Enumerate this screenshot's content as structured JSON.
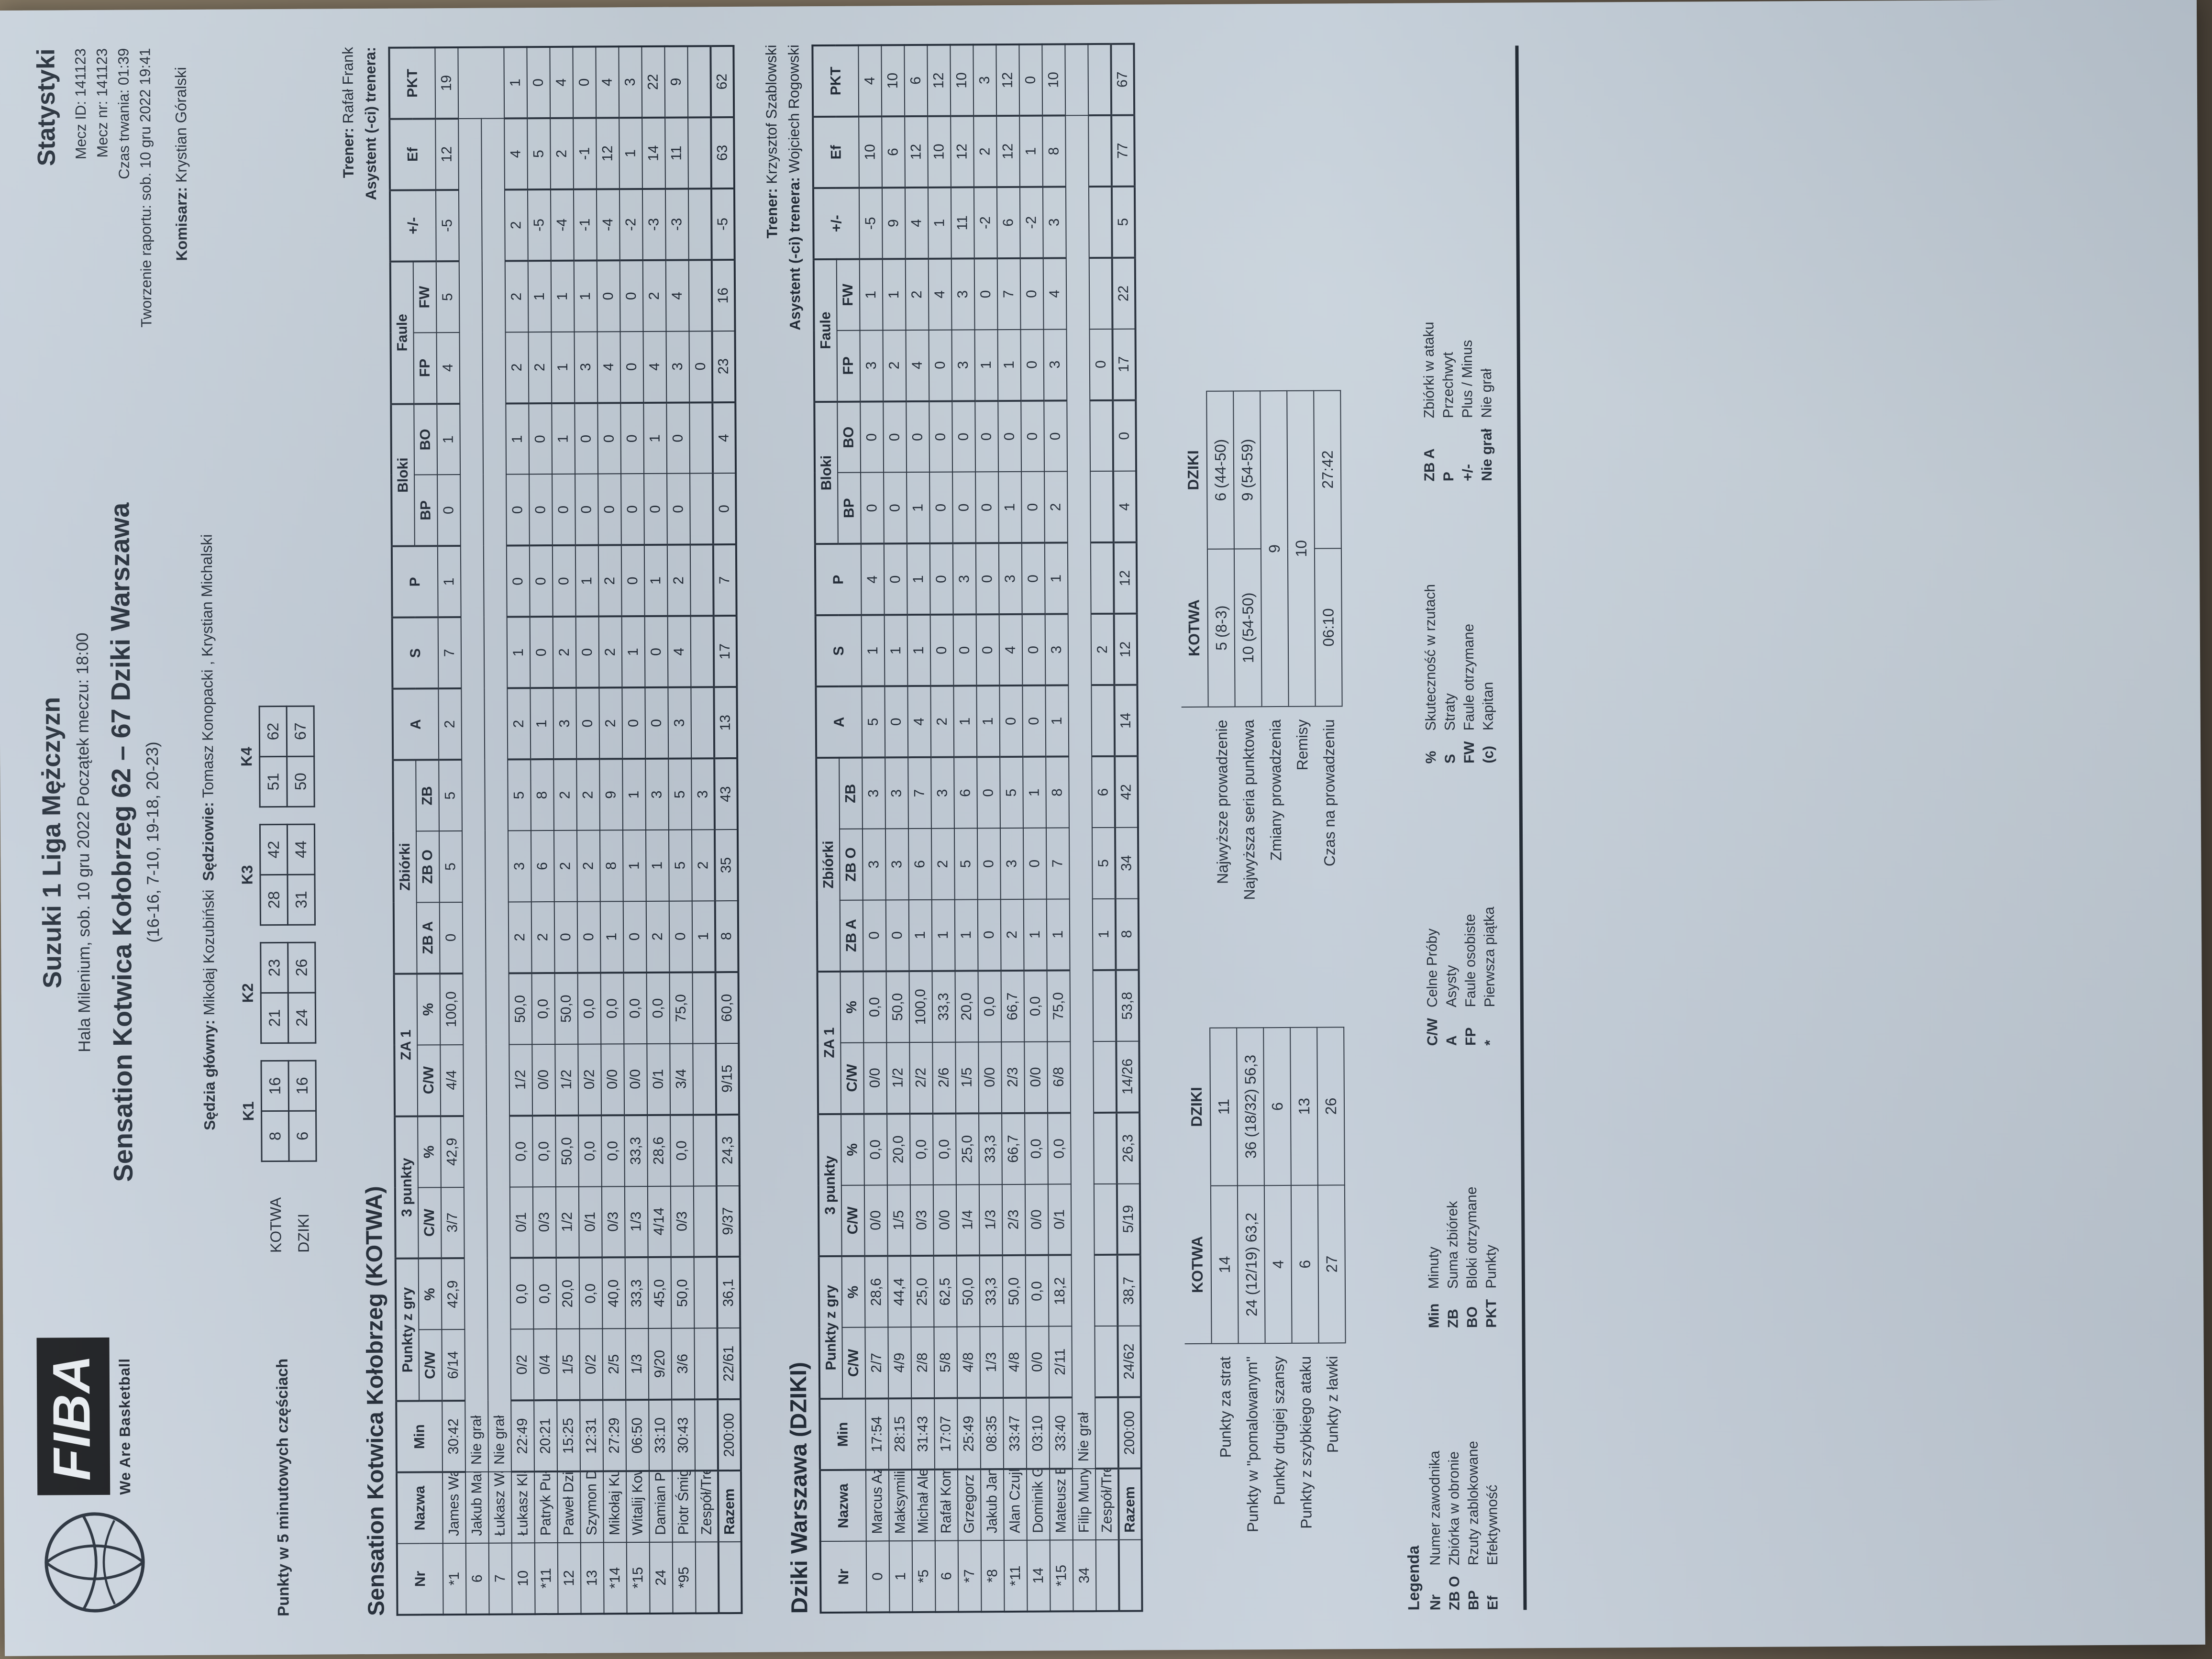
{
  "header": {
    "logo": {
      "fiba": "FIBA",
      "tagline": "We Are Basketball"
    },
    "title": "Suzuki 1 Liga Mężczyzn",
    "subtitle": "Hala Milenium, sob. 10 gru 2022 Początek meczu: 18:00",
    "match_line": "Sensation Kotwica Kołobrzeg 62 – 67 Dziki Warszawa",
    "quarters_line": "(16-16, 7-10, 19-18, 20-23)",
    "stats_label": "Statystyki",
    "meta": [
      "Mecz ID: 141123",
      "Mecz nr: 141123",
      "Czas trwania: 01:39",
      "Tworzenie raportu: sob. 10 gru 2022 19:41"
    ],
    "commissioner": {
      "label": "Komisarz:",
      "value": "Krystian Góralski"
    },
    "referee_main": {
      "label": "Sędzia główny:",
      "value": "Mikołaj Kozubiński"
    },
    "referees": {
      "label": "Sędziowie:",
      "value": "Tomasz Konopacki , Krystian Michalski"
    }
  },
  "quarter_scores": {
    "label": "Punkty w 5 minutowych częściach",
    "teams": [
      "KOTWA",
      "DZIKI"
    ],
    "quarters": [
      "K1",
      "K2",
      "K3",
      "K4"
    ],
    "values": [
      [
        [
          "8",
          "16"
        ],
        [
          "21",
          "23"
        ],
        [
          "28",
          "42"
        ],
        [
          "51",
          "62"
        ]
      ],
      [
        [
          "6",
          "16"
        ],
        [
          "24",
          "26"
        ],
        [
          "31",
          "44"
        ],
        [
          "50",
          "67"
        ]
      ]
    ]
  },
  "roster_header": {
    "top": [
      {
        "t": "Nr",
        "rs": 2
      },
      {
        "t": "Nazwa",
        "rs": 2
      },
      {
        "t": "Min",
        "rs": 2
      },
      {
        "t": "Punkty z gry",
        "cs": 2
      },
      {
        "t": "3 punkty",
        "cs": 2
      },
      {
        "t": "ZA 1",
        "cs": 2
      },
      {
        "t": "Zbiórki",
        "cs": 3
      },
      {
        "t": "A",
        "rs": 2
      },
      {
        "t": "S",
        "rs": 2
      },
      {
        "t": "P",
        "rs": 2
      },
      {
        "t": "Bloki",
        "cs": 2
      },
      {
        "t": "Faule",
        "cs": 2
      },
      {
        "t": "+/-",
        "rs": 2
      },
      {
        "t": "Ef",
        "rs": 2
      },
      {
        "t": "PKT",
        "rs": 2
      }
    ],
    "bottom": [
      "C/W",
      "%",
      "C/W",
      "%",
      "C/W",
      "%",
      "ZB A",
      "ZB O",
      "ZB",
      "BP",
      "BO",
      "FP",
      "FW"
    ]
  },
  "tables": [
    {
      "section_title": "Sensation Kotwica Kołobrzeg (KOTWA)",
      "coach": {
        "label": "Trener:",
        "value": "Rafał Frank"
      },
      "assistant": {
        "label": "Asystent (-ci) trenera:",
        "value": ""
      },
      "rows": [
        {
          "cells": [
            "*1",
            "James Washington",
            "30:42",
            "6/14",
            "42,9",
            "3/7",
            "42,9",
            "4/4",
            "100,0",
            "0",
            "5",
            "5",
            "2",
            "7",
            "1",
            "0",
            "1",
            "4",
            "5",
            "-5",
            "12",
            "19"
          ]
        },
        {
          "dnp": true,
          "cells": [
            "6",
            "Jakub Marchlewski",
            "Nie grał"
          ]
        },
        {
          "dnp": true,
          "cells": [
            "7",
            "Łukasz Walkowiak",
            "Nie grał"
          ]
        },
        {
          "cells": [
            "10",
            "Łukasz Klawa",
            "22:49",
            "0/2",
            "0,0",
            "0/1",
            "0,0",
            "1/2",
            "50,0",
            "2",
            "3",
            "5",
            "2",
            "1",
            "0",
            "0",
            "1",
            "2",
            "2",
            "2",
            "4",
            "1"
          ]
        },
        {
          "cells": [
            "*11",
            "Patryk Pułkotycki",
            "20:21",
            "0/4",
            "0,0",
            "0/3",
            "0,0",
            "0/0",
            "0,0",
            "2",
            "6",
            "8",
            "1",
            "0",
            "0",
            "0",
            "0",
            "2",
            "1",
            "-5",
            "5",
            "0"
          ]
        },
        {
          "cells": [
            "12",
            "Paweł Dzierżak",
            "15:25",
            "1/5",
            "20,0",
            "1/2",
            "50,0",
            "1/2",
            "50,0",
            "0",
            "2",
            "2",
            "3",
            "2",
            "0",
            "0",
            "1",
            "1",
            "1",
            "-4",
            "2",
            "4"
          ]
        },
        {
          "cells": [
            "13",
            "Szymon Długosz",
            "12:31",
            "0/2",
            "0,0",
            "0/1",
            "0,0",
            "0/2",
            "0,0",
            "0",
            "2",
            "2",
            "0",
            "0",
            "1",
            "0",
            "0",
            "3",
            "1",
            "-1",
            "-1",
            "0"
          ]
        },
        {
          "cells": [
            "*14",
            "Mikołaj Kurpisz",
            "27:29",
            "2/5",
            "40,0",
            "0/3",
            "0,0",
            "0/0",
            "0,0",
            "1",
            "8",
            "9",
            "2",
            "2",
            "2",
            "0",
            "0",
            "4",
            "0",
            "-4",
            "12",
            "4"
          ]
        },
        {
          "cells": [
            "*15",
            "Witalij Kowalenko",
            "06:50",
            "1/3",
            "33,3",
            "1/3",
            "33,3",
            "0/0",
            "0,0",
            "0",
            "1",
            "1",
            "0",
            "1",
            "0",
            "0",
            "0",
            "0",
            "0",
            "-2",
            "1",
            "3"
          ]
        },
        {
          "cells": [
            "24",
            "Damian Pieloch",
            "33:10",
            "9/20",
            "45,0",
            "4/14",
            "28,6",
            "0/1",
            "0,0",
            "2",
            "1",
            "3",
            "0",
            "0",
            "1",
            "0",
            "1",
            "4",
            "2",
            "-3",
            "14",
            "22"
          ]
        },
        {
          "cells": [
            "*95",
            "Piotr Śmigielski (C)",
            "30:43",
            "3/6",
            "50,0",
            "0/3",
            "0,0",
            "3/4",
            "75,0",
            "0",
            "5",
            "5",
            "3",
            "4",
            "2",
            "0",
            "0",
            "3",
            "4",
            "-3",
            "11",
            "9"
          ]
        }
      ],
      "team_row": [
        "",
        "Zespół/Trener",
        "",
        "",
        "",
        "",
        "",
        "",
        "",
        "1",
        "2",
        "3",
        "",
        "",
        "",
        "",
        "",
        "0",
        "",
        "",
        "",
        ""
      ],
      "total_row": [
        "",
        "Razem",
        "200:00",
        "22/61",
        "36,1",
        "9/37",
        "24,3",
        "9/15",
        "60,0",
        "8",
        "35",
        "43",
        "13",
        "17",
        "7",
        "0",
        "4",
        "23",
        "16",
        "-5",
        "63",
        "62"
      ]
    },
    {
      "section_title": "Dziki Warszawa (DZIKI)",
      "coach": {
        "label": "Trener:",
        "value": "Krzysztof Szablowski"
      },
      "assistant": {
        "label": "Asystent (-ci) trenera:",
        "value": "Wojciech Rogowski"
      },
      "rows": [
        {
          "cells": [
            "0",
            "Marcus Azor",
            "17:54",
            "2/7",
            "28,6",
            "0/0",
            "0,0",
            "0/0",
            "0,0",
            "0",
            "3",
            "3",
            "5",
            "1",
            "4",
            "0",
            "0",
            "3",
            "1",
            "-5",
            "10",
            "4"
          ]
        },
        {
          "cells": [
            "1",
            "Maksymilian Motel",
            "28:15",
            "4/9",
            "44,4",
            "1/5",
            "20,0",
            "1/2",
            "50,0",
            "0",
            "3",
            "3",
            "0",
            "1",
            "0",
            "0",
            "0",
            "2",
            "1",
            "9",
            "6",
            "10"
          ]
        },
        {
          "cells": [
            "*5",
            "Michał Aleksandrowicz",
            "31:43",
            "2/8",
            "25,0",
            "0/3",
            "0,0",
            "2/2",
            "100,0",
            "1",
            "6",
            "7",
            "4",
            "1",
            "1",
            "1",
            "0",
            "4",
            "2",
            "4",
            "12",
            "6"
          ]
        },
        {
          "cells": [
            "6",
            "Rafał Komenda",
            "17:07",
            "5/8",
            "62,5",
            "0/0",
            "0,0",
            "2/6",
            "33,3",
            "1",
            "2",
            "3",
            "2",
            "0",
            "0",
            "0",
            "0",
            "0",
            "4",
            "1",
            "10",
            "12"
          ]
        },
        {
          "cells": [
            "*7",
            "Grzegorz Grochowski (C)",
            "25:49",
            "4/8",
            "50,0",
            "1/4",
            "25,0",
            "1/5",
            "20,0",
            "1",
            "5",
            "6",
            "1",
            "0",
            "3",
            "0",
            "0",
            "3",
            "3",
            "11",
            "12",
            "10"
          ]
        },
        {
          "cells": [
            "*8",
            "Jakub Janik",
            "08:35",
            "1/3",
            "33,3",
            "1/3",
            "33,3",
            "0/0",
            "0,0",
            "0",
            "0",
            "0",
            "1",
            "0",
            "0",
            "0",
            "0",
            "1",
            "0",
            "-2",
            "2",
            "3"
          ]
        },
        {
          "cells": [
            "*11",
            "Alan Czujkowski",
            "33:47",
            "4/8",
            "50,0",
            "2/3",
            "66,7",
            "2/3",
            "66,7",
            "2",
            "3",
            "5",
            "0",
            "4",
            "3",
            "1",
            "0",
            "1",
            "7",
            "6",
            "12",
            "12"
          ]
        },
        {
          "cells": [
            "14",
            "Dominik Groth",
            "03:10",
            "0/0",
            "0,0",
            "0/0",
            "0,0",
            "0/0",
            "0,0",
            "1",
            "0",
            "1",
            "0",
            "0",
            "0",
            "0",
            "0",
            "0",
            "0",
            "-2",
            "1",
            "0"
          ]
        },
        {
          "cells": [
            "*15",
            "Mateusz Bartosz",
            "33:40",
            "2/11",
            "18,2",
            "0/1",
            "0,0",
            "6/8",
            "75,0",
            "1",
            "7",
            "8",
            "1",
            "3",
            "1",
            "2",
            "0",
            "3",
            "4",
            "3",
            "8",
            "10"
          ]
        },
        {
          "dnp": true,
          "cells": [
            "34",
            "Filip Munyama",
            "Nie grał"
          ]
        }
      ],
      "team_row": [
        "",
        "Zespół/Trener",
        "",
        "",
        "",
        "",
        "",
        "",
        "",
        "1",
        "5",
        "6",
        "",
        "2",
        "",
        "",
        "",
        "0",
        "",
        "",
        "",
        ""
      ],
      "total_row": [
        "",
        "Razem",
        "200:00",
        "24/62",
        "38,7",
        "5/19",
        "26,3",
        "14/26",
        "53,8",
        "8",
        "34",
        "42",
        "14",
        "12",
        "12",
        "4",
        "0",
        "17",
        "22",
        "5",
        "77",
        "67"
      ]
    }
  ],
  "summary": {
    "columns": [
      "KOTWA",
      "DZIKI"
    ],
    "left_rows": [
      {
        "label": "Punkty za strat",
        "k": "14",
        "d": "11"
      },
      {
        "label": "Punkty w \"pomalowanym\"",
        "k": "24 (12/19) 63,2",
        "d": "36 (18/32) 56,3"
      },
      {
        "label": "Punkty drugiej szansy",
        "k": "4",
        "d": "6"
      },
      {
        "label": "Punkty z szybkiego ataku",
        "k": "6",
        "d": "13"
      },
      {
        "label": "Punkty z ławki",
        "k": "27",
        "d": "26"
      }
    ],
    "right_rows": [
      {
        "label": "Najwyższe prowadzenie",
        "k": "5 (8-3)",
        "d": "6 (44-50)"
      },
      {
        "label": "Najwyższa seria punktowa",
        "k": "10 (54-50)",
        "d": "9 (54-59)"
      },
      {
        "label": "Zmiany prowadzenia",
        "merged": "9"
      },
      {
        "label": "Remisy",
        "merged": "10"
      },
      {
        "label": "Czas na prowadzeniu",
        "k": "06:10",
        "d": "27:42"
      }
    ]
  },
  "legend": {
    "title": "Legenda",
    "columns": [
      [
        {
          "k": "Nr",
          "v": "Numer zawodnika"
        },
        {
          "k": "ZB O",
          "v": "Zbiórka w obronie"
        },
        {
          "k": "BP",
          "v": "Rzuty zablokowane"
        },
        {
          "k": "Ef",
          "v": "Efektywność"
        }
      ],
      [
        {
          "k": "Min",
          "v": "Minuty"
        },
        {
          "k": "ZB",
          "v": "Suma zbiórek"
        },
        {
          "k": "BO",
          "v": "Bloki otrzymane"
        },
        {
          "k": "PKT",
          "v": "Punkty"
        }
      ],
      [
        {
          "k": "C/W",
          "v": "Celne Próby"
        },
        {
          "k": "A",
          "v": "Asysty"
        },
        {
          "k": "FP",
          "v": "Faule osobiste"
        },
        {
          "k": "*",
          "v": "Pierwsza piątka"
        }
      ],
      [
        {
          "k": "%",
          "v": "Skuteczność w rzutach"
        },
        {
          "k": "S",
          "v": "Straty"
        },
        {
          "k": "FW",
          "v": "Faule otrzymane"
        },
        {
          "k": "(c)",
          "v": "Kapitan"
        }
      ],
      [
        {
          "k": "ZB A",
          "v": "Zbiórki w ataku"
        },
        {
          "k": "P",
          "v": "Przechwyt"
        },
        {
          "k": "+/-",
          "v": "Plus / Minus"
        },
        {
          "k": "Nie grał",
          "v": "Nie grał"
        }
      ]
    ]
  }
}
